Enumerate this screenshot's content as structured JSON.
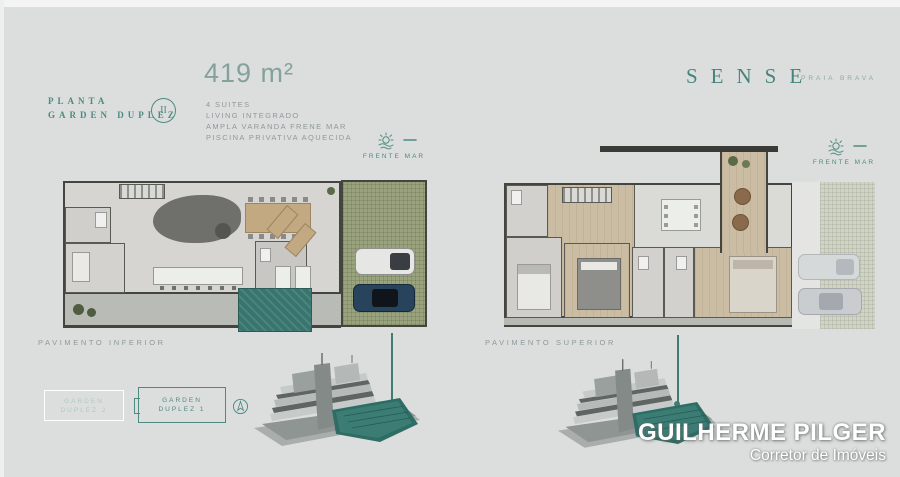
{
  "header": {
    "kicker": "PLANTA",
    "title": "GARDEN DUPLEZ",
    "unit_numeral": "II",
    "area": "419 m²",
    "features": [
      "4 SUITES",
      "LIVING INTEGRADO",
      "AMPLA VARANDA FRENE MAR",
      "PISCINA PRIVATIVA AQUECIDA"
    ]
  },
  "brand": {
    "name": "SENSE",
    "subtitle": "PRAIA BRAVA"
  },
  "floorplans": {
    "inferior": {
      "label": "PAVIMENTO INFERIOR",
      "seafront_label": "FRENTE MAR"
    },
    "superior": {
      "label": "PAVIMENTO SUPERIOR",
      "seafront_label": "FRENTE MAR"
    }
  },
  "unit_key": {
    "faded": {
      "line1": "GARDEN",
      "line2": "DUPLEZ 2"
    },
    "highlighted": {
      "line1": "GARDEN",
      "line2": "DUPLEZ 1"
    }
  },
  "agent": {
    "name": "GUILHERME PILGER",
    "role": "Corretor de Imóveis"
  },
  "colors": {
    "background": "#dcdedd",
    "accent_teal": "#4d8b80",
    "pool_teal": "#37756e",
    "building_highlight": "#2f6e66",
    "text_gray": "#8d989a"
  }
}
